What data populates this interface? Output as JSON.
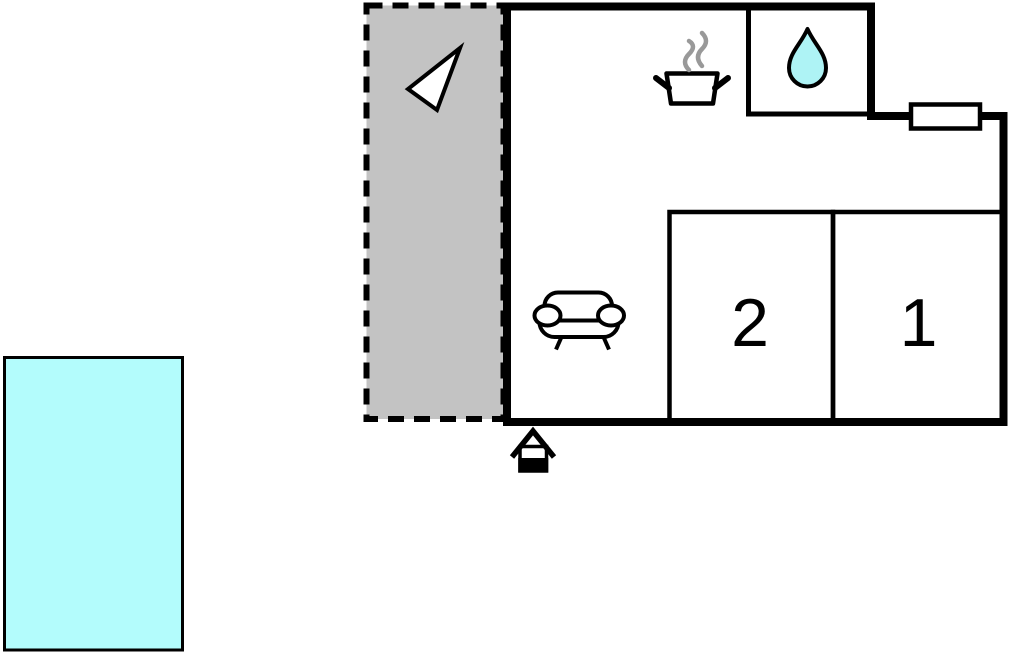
{
  "floor_plan": {
    "description": "apartment floor plan with pool and terrace",
    "rooms": [
      {
        "id": "bedroom-2",
        "label": "2"
      },
      {
        "id": "bedroom-1",
        "label": "1"
      }
    ],
    "areas": {
      "pool": "swimming pool",
      "terrace": "terrace",
      "bathroom": "bathroom",
      "kitchen": "kitchen",
      "living_room": "living room"
    },
    "icons": {
      "compass_arrow": "direction-arrow-icon",
      "cooking_pot": "cooking-pot-icon",
      "steam": "steam-icon",
      "water_drop": "water-drop-icon",
      "window": "window-marker",
      "sofa": "sofa-icon",
      "entrance": "entrance-house-icon"
    },
    "colors": {
      "pool_fill": "#b3fcfc",
      "water_drop_fill": "#aef3f5",
      "terrace_fill": "#c3c3c3",
      "wall": "#000000",
      "steam": "#999999",
      "background": "#ffffff"
    }
  }
}
